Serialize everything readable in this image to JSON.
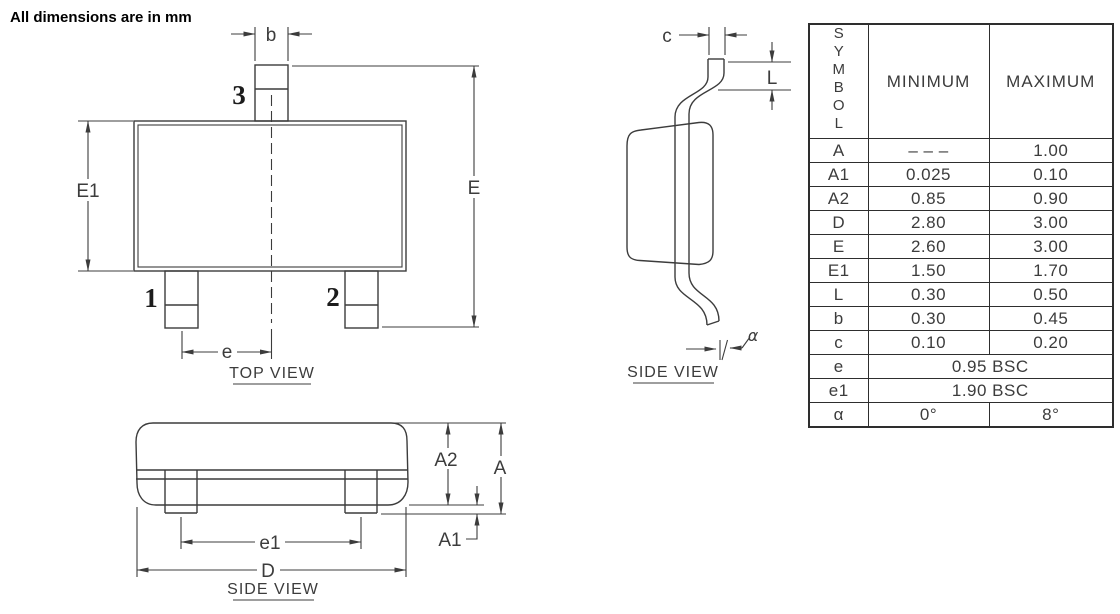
{
  "note": "All dimensions are in mm",
  "top_view": {
    "label": "TOP VIEW",
    "pin1": "1",
    "pin2": "2",
    "pin3": "3",
    "dim_b": "b",
    "dim_e": "e",
    "dim_E": "E",
    "dim_E1": "E1"
  },
  "side_view": {
    "label": "SIDE VIEW",
    "dim_c": "c",
    "dim_L": "L",
    "dim_alpha": "α"
  },
  "front_view": {
    "label": "SIDE VIEW",
    "dim_A": "A",
    "dim_A1": "A1",
    "dim_A2": "A2",
    "dim_e1": "e1",
    "dim_D": "D"
  },
  "table": {
    "headers": {
      "symbol": "SYMBOL",
      "min": "MINIMUM",
      "max": "MAXIMUM"
    },
    "rows": [
      {
        "symbol": "A",
        "min": "– – –",
        "max": "1.00"
      },
      {
        "symbol": "A1",
        "min": "0.025",
        "max": "0.10"
      },
      {
        "symbol": "A2",
        "min": "0.85",
        "max": "0.90"
      },
      {
        "symbol": "D",
        "min": "2.80",
        "max": "3.00"
      },
      {
        "symbol": "E",
        "min": "2.60",
        "max": "3.00"
      },
      {
        "symbol": "E1",
        "min": "1.50",
        "max": "1.70"
      },
      {
        "symbol": "L",
        "min": "0.30",
        "max": "0.50"
      },
      {
        "symbol": "b",
        "min": "0.30",
        "max": "0.45"
      },
      {
        "symbol": "c",
        "min": "0.10",
        "max": "0.20"
      },
      {
        "symbol": "e",
        "span": "0.95  BSC"
      },
      {
        "symbol": "e1",
        "span": "1.90  BSC"
      },
      {
        "symbol": "α",
        "min": "0°",
        "max": "8°"
      }
    ]
  }
}
